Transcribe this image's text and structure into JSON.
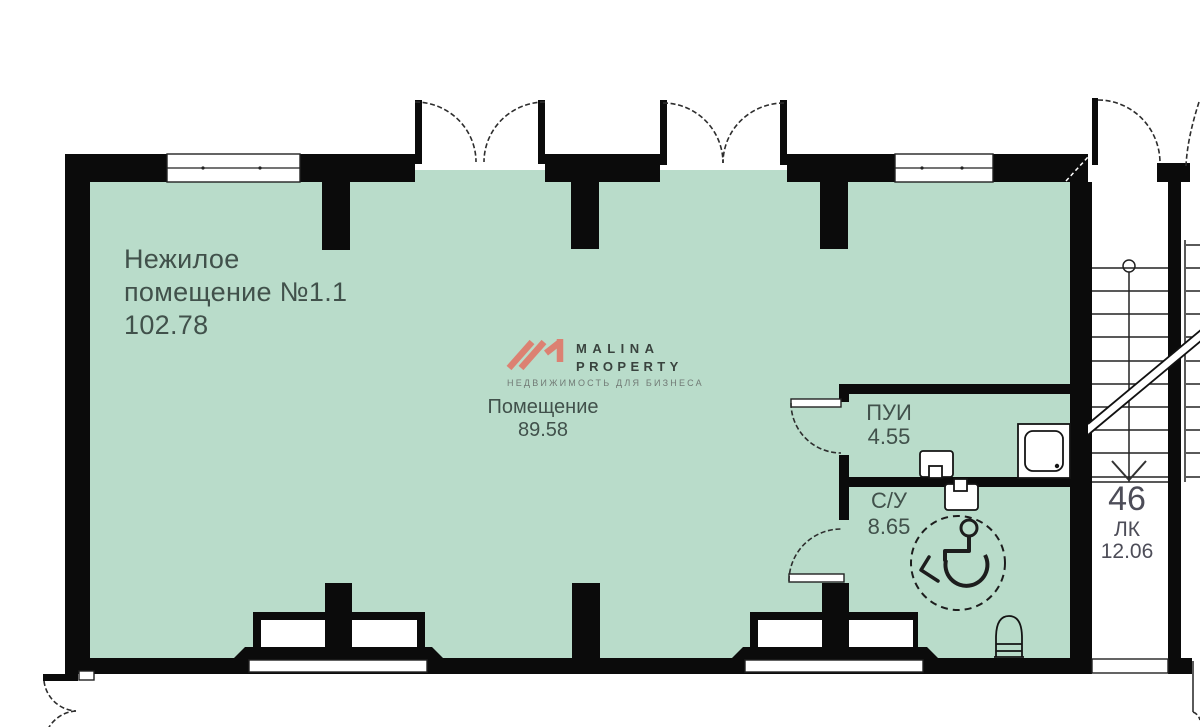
{
  "colors": {
    "room_fill": "#b9dcca",
    "wall": "#0b0b0b",
    "line": "#222222",
    "label_text": "#41514b",
    "stair_text": "#4d4d58",
    "logo_accent": "#dc8172",
    "logo_text": "#39433e",
    "logo_tagline": "#717a75"
  },
  "plan": {
    "unit": {
      "name_line1": "Нежилое",
      "name_line2": "помещение №1.1",
      "area": "102.78"
    },
    "hall": {
      "name": "Помещение",
      "area": "89.58"
    },
    "pui": {
      "name": "ПУИ",
      "area": "4.55"
    },
    "su": {
      "name": "С/У",
      "area": "8.65"
    },
    "stairwell": {
      "number": "46",
      "name": "ЛК",
      "area": "12.06"
    }
  },
  "logo": {
    "name_line1": "MALINA",
    "name_line2": "PROPERTY",
    "tagline": "НЕДВИЖИМОСТЬ ДЛЯ БИЗНЕСА"
  }
}
